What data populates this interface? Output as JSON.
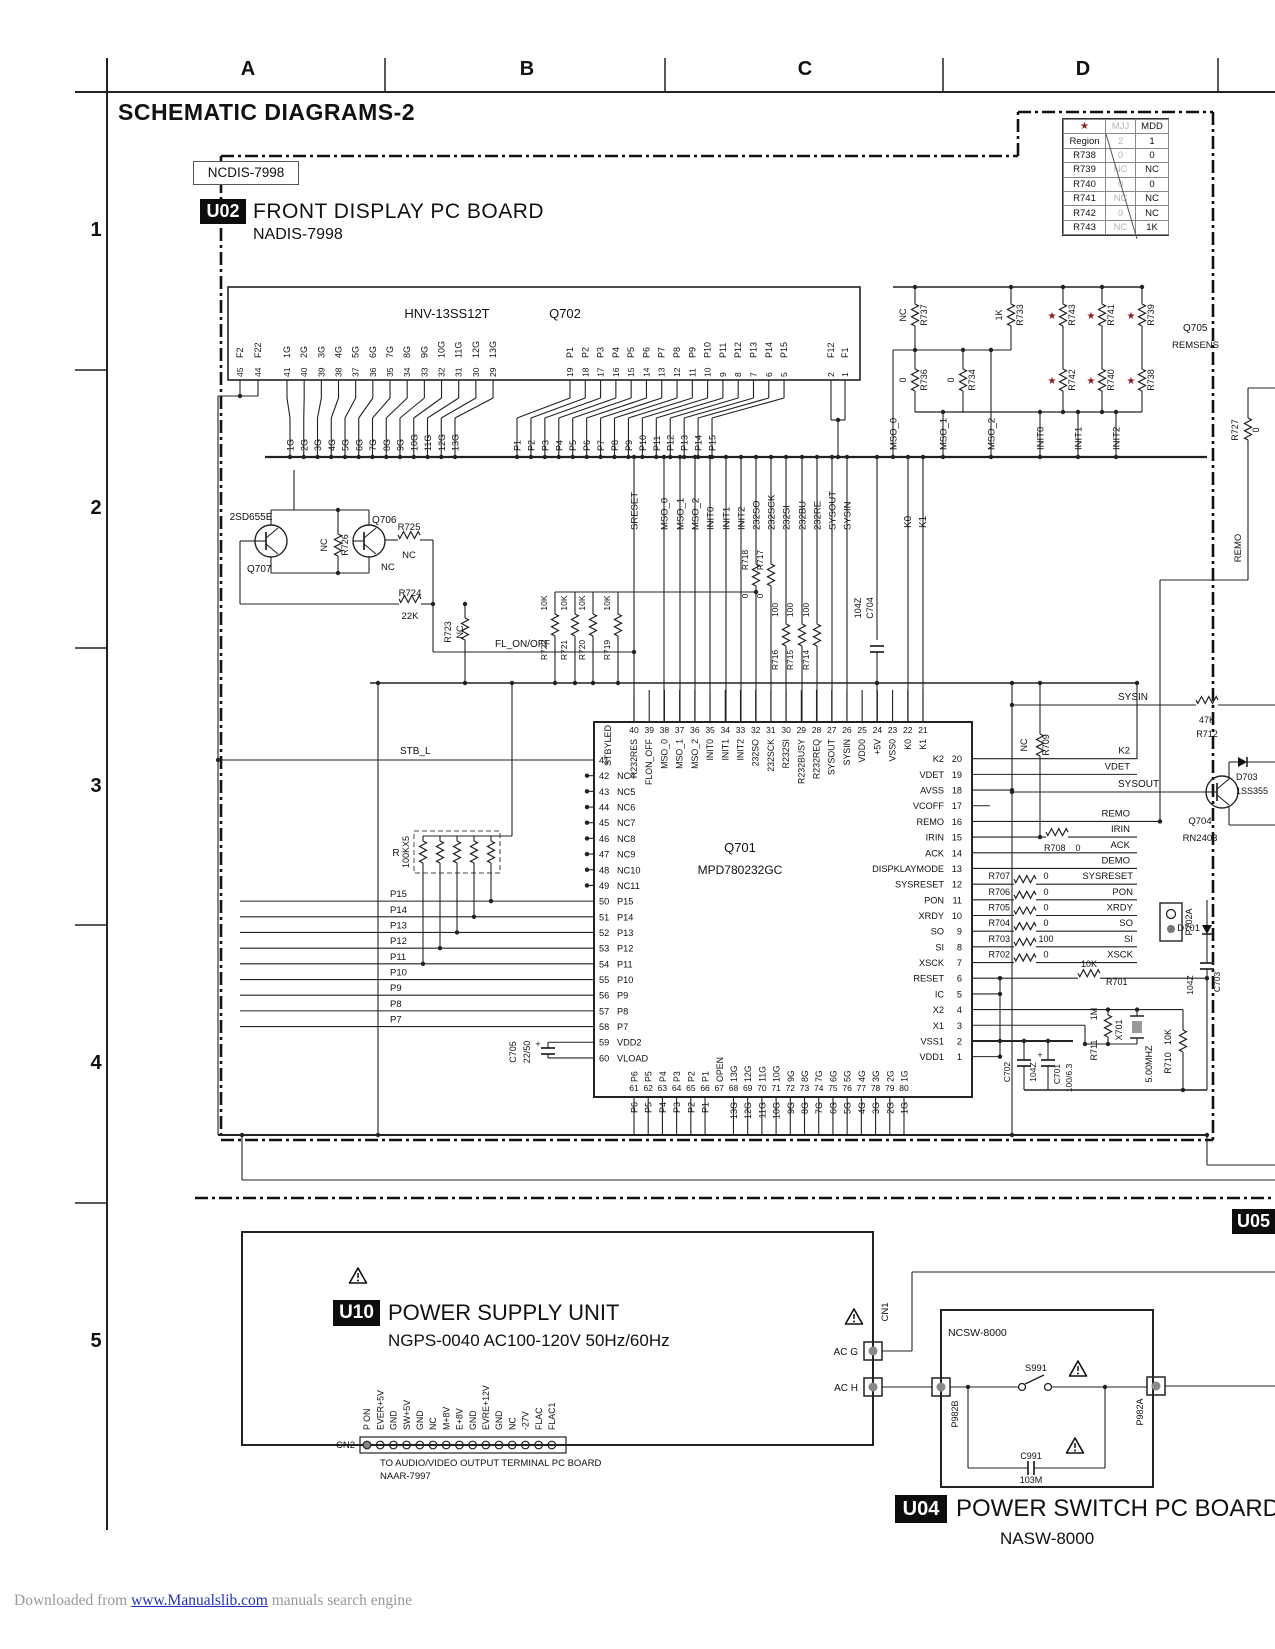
{
  "page": {
    "title": "SCHEMATIC DIAGRAMS-2",
    "grid_columns": [
      "A",
      "B",
      "C",
      "D"
    ],
    "grid_rows": [
      "1",
      "2",
      "3",
      "4",
      "5"
    ],
    "footer": {
      "prefix": "Downloaded from ",
      "link_text": "www.Manualslib.com",
      "suffix": " manuals search engine"
    }
  },
  "region_table": {
    "header": [
      "★",
      "MJJ",
      "MDD"
    ],
    "rows": [
      [
        "Region",
        "2",
        "1"
      ],
      [
        "R738",
        "0",
        "0"
      ],
      [
        "R739",
        "NC",
        "NC"
      ],
      [
        "R740",
        "0",
        "0"
      ],
      [
        "R741",
        "NC",
        "NC"
      ],
      [
        "R742",
        "0",
        "NC"
      ],
      [
        "R743",
        "NC",
        "1K"
      ]
    ]
  },
  "u02": {
    "board_label": "NCDIS-7998",
    "badge": "U02",
    "title": "FRONT DISPLAY PC BOARD",
    "subtitle": "NADIS-7998",
    "connector": {
      "name": "HNV-13SS12T",
      "ref": "Q702",
      "pins_f_left": [
        [
          "45",
          "F2"
        ],
        [
          "44",
          "F22"
        ]
      ],
      "pins_g": [
        [
          "41",
          "1G"
        ],
        [
          "40",
          "2G"
        ],
        [
          "39",
          "3G"
        ],
        [
          "38",
          "4G"
        ],
        [
          "37",
          "5G"
        ],
        [
          "36",
          "6G"
        ],
        [
          "35",
          "7G"
        ],
        [
          "34",
          "8G"
        ],
        [
          "33",
          "9G"
        ],
        [
          "32",
          "10G"
        ],
        [
          "31",
          "11G"
        ],
        [
          "30",
          "12G"
        ],
        [
          "29",
          "13G"
        ]
      ],
      "pins_p": [
        [
          "19",
          "P1"
        ],
        [
          "18",
          "P2"
        ],
        [
          "17",
          "P3"
        ],
        [
          "16",
          "P4"
        ],
        [
          "15",
          "P5"
        ],
        [
          "14",
          "P6"
        ],
        [
          "13",
          "P7"
        ],
        [
          "12",
          "P8"
        ],
        [
          "11",
          "P9"
        ],
        [
          "10",
          "P10"
        ],
        [
          "9",
          "P11"
        ],
        [
          "8",
          "P12"
        ],
        [
          "7",
          "P13"
        ],
        [
          "6",
          "P14"
        ],
        [
          "5",
          "P15"
        ]
      ],
      "pins_f_right": [
        [
          "2",
          "F12"
        ],
        [
          "1",
          "F1"
        ]
      ],
      "bus_g": [
        "1G",
        "2G",
        "3G",
        "4G",
        "5G",
        "6G",
        "7G",
        "8G",
        "9G",
        "10G",
        "11G",
        "12G",
        "13G"
      ],
      "bus_p": [
        "P1",
        "P2",
        "P3",
        "P4",
        "P5",
        "P6",
        "P7",
        "P8",
        "P9",
        "P10",
        "P11",
        "P12",
        "P13",
        "P14",
        "P15"
      ]
    },
    "bank": {
      "top": [
        [
          "R737",
          "NC"
        ],
        [
          "R733",
          "1K"
        ],
        [
          "R743",
          "*"
        ],
        [
          "R741",
          "*"
        ],
        [
          "R739",
          "*"
        ]
      ],
      "bottom": [
        [
          "R736",
          "0"
        ],
        [
          "R734",
          "0"
        ],
        [
          "R742",
          "*"
        ],
        [
          "R740",
          "*"
        ],
        [
          "R738",
          "*"
        ]
      ],
      "signals": [
        "MSO_0",
        "MSO_1",
        "MSO_2",
        "INIT0",
        "INIT1",
        "INIT2"
      ]
    },
    "q705": {
      "ref": "Q705",
      "label": "REMSENS",
      "r727": [
        "R727",
        "0"
      ],
      "net": "REMO"
    },
    "drivers": {
      "q707_part": "2SD655E",
      "q707": "Q707",
      "q706": "Q706",
      "q706_val": "NC",
      "r726": [
        "NC",
        "R726"
      ],
      "r725": [
        "R725",
        "NC"
      ],
      "r724": [
        "R724",
        "22K"
      ],
      "r723": [
        "R723",
        "NC"
      ],
      "fl": "FL_ON/OFF",
      "pullups": [
        [
          "10K",
          "R722"
        ],
        [
          "10K",
          "R721"
        ],
        [
          "10K",
          "R720"
        ],
        [
          "10K",
          "R719"
        ]
      ]
    },
    "signal_cols": [
      "SRESET",
      "MSO_0",
      "MSO_1",
      "MSO_2",
      "INIT0",
      "INIT1",
      "INIT2",
      "232SO",
      "232SCK",
      "232SI",
      "232BU",
      "232RE",
      "SYSOUT",
      "SYSIN"
    ],
    "inline_res": {
      "r718": [
        "R718",
        "0"
      ],
      "r717": [
        "R717",
        "0"
      ],
      "r716": [
        "R716",
        "100"
      ],
      "r715": [
        "R715",
        "100"
      ],
      "r714": [
        "R714",
        "100"
      ]
    },
    "c704": [
      "104Z",
      "C704"
    ],
    "k0": "K0",
    "k1": "K1",
    "ic": {
      "ref": "Q701",
      "part": "MPD780232GC",
      "pins_left": [
        [
          "41",
          "STBYLED"
        ],
        [
          "42",
          "NC4"
        ],
        [
          "43",
          "NC5"
        ],
        [
          "44",
          "NC6"
        ],
        [
          "45",
          "NC7"
        ],
        [
          "46",
          "NC8"
        ],
        [
          "47",
          "NC9"
        ],
        [
          "48",
          "NC10"
        ],
        [
          "49",
          "NC11"
        ],
        [
          "50",
          "P15"
        ],
        [
          "51",
          "P14"
        ],
        [
          "52",
          "P13"
        ],
        [
          "53",
          "P12"
        ],
        [
          "54",
          "P11"
        ],
        [
          "55",
          "P10"
        ],
        [
          "56",
          "P9"
        ],
        [
          "57",
          "P8"
        ],
        [
          "58",
          "P7"
        ],
        [
          "59",
          "VDD2"
        ],
        [
          "60",
          "VLOAD"
        ]
      ],
      "pins_top": [
        [
          "40",
          "R232RES"
        ],
        [
          "39",
          "FLON_OFF"
        ],
        [
          "38",
          "MSO_0"
        ],
        [
          "37",
          "MSO_1"
        ],
        [
          "36",
          "MSO_2"
        ],
        [
          "35",
          "INIT0"
        ],
        [
          "34",
          "INIT1"
        ],
        [
          "33",
          "INIT2"
        ],
        [
          "32",
          "232SO"
        ],
        [
          "31",
          "232SCK"
        ],
        [
          "30",
          "R232SI"
        ],
        [
          "29",
          "R232BUSY"
        ],
        [
          "28",
          "R232REQ"
        ],
        [
          "27",
          "SYSOUT"
        ],
        [
          "26",
          "SYSIN"
        ],
        [
          "25",
          "VDD0"
        ],
        [
          "24",
          "+5V"
        ],
        [
          "23",
          "VSS0"
        ],
        [
          "22",
          "K0"
        ],
        [
          "21",
          "K1"
        ]
      ],
      "pins_right": [
        [
          "20",
          "K2"
        ],
        [
          "19",
          "VDET"
        ],
        [
          "18",
          "AVSS"
        ],
        [
          "17",
          "VCOFF"
        ],
        [
          "16",
          "REMO"
        ],
        [
          "15",
          "IRIN"
        ],
        [
          "14",
          "ACK"
        ],
        [
          "13",
          "DISPKLAYMODE"
        ],
        [
          "12",
          "SYSRESET"
        ],
        [
          "11",
          "PON"
        ],
        [
          "10",
          "XRDY"
        ],
        [
          "9",
          "SO"
        ],
        [
          "8",
          "SI"
        ],
        [
          "7",
          "XSCK"
        ],
        [
          "6",
          "RESET"
        ],
        [
          "5",
          "IC"
        ],
        [
          "4",
          "X2"
        ],
        [
          "3",
          "X1"
        ],
        [
          "2",
          "VSS1"
        ],
        [
          "1",
          "VDD1"
        ]
      ],
      "pins_bottom": [
        [
          "61",
          "P6"
        ],
        [
          "62",
          "P5"
        ],
        [
          "63",
          "P4"
        ],
        [
          "64",
          "P3"
        ],
        [
          "65",
          "P2"
        ],
        [
          "66",
          "P1"
        ],
        [
          "67",
          "OPEN"
        ],
        [
          "68",
          "13G"
        ],
        [
          "69",
          "12G"
        ],
        [
          "70",
          "11G"
        ],
        [
          "71",
          "10G"
        ],
        [
          "72",
          "9G"
        ],
        [
          "73",
          "8G"
        ],
        [
          "74",
          "7G"
        ],
        [
          "75",
          "6G"
        ],
        [
          "76",
          "5G"
        ],
        [
          "77",
          "4G"
        ],
        [
          "78",
          "3G"
        ],
        [
          "79",
          "2G"
        ],
        [
          "80",
          "1G"
        ]
      ],
      "ext_bottom": [
        "P6",
        "P5",
        "P4",
        "P3",
        "P2",
        "P1",
        "",
        "13G",
        "12G",
        "11G",
        "10G",
        "9G",
        "8G",
        "7G",
        "6G",
        "5G",
        "4G",
        "3G",
        "2G",
        "1G"
      ]
    },
    "left_area": {
      "stb": "STB_L",
      "array_ref": "R",
      "array_val": "100KX5",
      "nets": [
        "P15",
        "P14",
        "P13",
        "P12",
        "P11",
        "P10",
        "P9",
        "P8",
        "P7"
      ],
      "c705": [
        "C705",
        "22/50"
      ]
    },
    "right_area": {
      "r709": [
        "NC",
        "R709"
      ],
      "r708": [
        "R708",
        "0"
      ],
      "ext": [
        "K2",
        "VDET",
        "REMO",
        "IRIN",
        "ACK",
        "DEMO",
        "SYSRESET",
        "PON",
        "XRDY",
        "SO",
        "SI",
        "XSCK"
      ],
      "series": [
        [
          "R707",
          "0"
        ],
        [
          "R706",
          "0"
        ],
        [
          "R705",
          "0"
        ],
        [
          "R704",
          "0"
        ],
        [
          "R703",
          "100"
        ],
        [
          "R702",
          "0"
        ]
      ],
      "r701": [
        "10K",
        "R701"
      ],
      "osc": {
        "r711": [
          "1M",
          "R711"
        ],
        "x701": "X701",
        "freq": "5.00MHZ",
        "r710": [
          "10K",
          "R710"
        ],
        "c701": [
          "C701",
          "100/6.3"
        ],
        "c702": [
          "C702",
          "104Z"
        ],
        "c703": [
          "104Z",
          "C703"
        ]
      },
      "d701": "D701",
      "sysin": "SYSIN",
      "r712": [
        "47K",
        "R712"
      ],
      "sysout": "SYSOUT",
      "q704": [
        "Q704",
        "RN2403"
      ],
      "d703": [
        "D703",
        "1SS355"
      ],
      "p702a": "P702A"
    }
  },
  "u05": {
    "badge": "U05"
  },
  "u10": {
    "badge": "U10",
    "title": "POWER SUPPLY UNIT",
    "subtitle": "NGPS-0040 AC100-120V 50Hz/60Hz",
    "cn2": "CN2",
    "cn2_pins": [
      "P ON",
      "EVER+5V",
      "GND",
      "SW+5V",
      "GND",
      "NC",
      "M+8V",
      "E+8V",
      "GND",
      "EVRE+12V",
      "GND",
      "NC",
      "-27V",
      "FLAC",
      "FLAC1"
    ],
    "note1": "TO AUDIO/VIDEO OUTPUT TERMINAL PC BOARD",
    "note2": "NAAR-7997",
    "ac_g": "AC G",
    "ac_h": "AC H",
    "cn1": "CN1"
  },
  "u04": {
    "badge": "U04",
    "title": "POWER SWITCH PC BOARD",
    "subtitle": "NASW-8000",
    "board": "NCSW-8000",
    "s991": "S991",
    "c991": [
      "C991",
      "103M"
    ],
    "p982b": "P982B",
    "p982a": "P982A"
  }
}
